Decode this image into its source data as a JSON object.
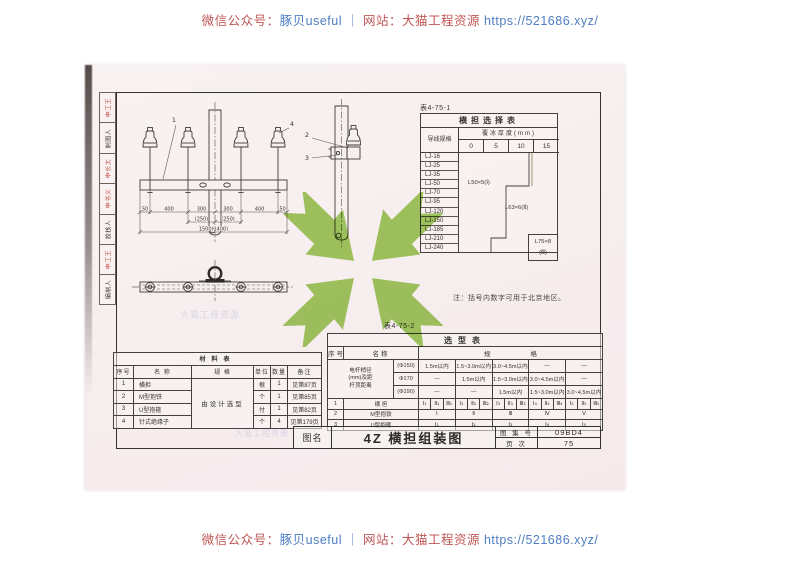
{
  "banner": {
    "wechat_label": "微信公众号：",
    "wechat_name": "豚贝useful",
    "separator": " ｜ ",
    "site_label": "网站：",
    "site_name": "大猫工程资源 ",
    "site_url": "https://521686.xyz/"
  },
  "stamps": [
    {
      "text": "申工王",
      "color": "red"
    },
    {
      "text": "制图人",
      "color": "black"
    },
    {
      "text": "申长太",
      "color": "red"
    },
    {
      "text": "申书义",
      "color": "red"
    },
    {
      "text": "校核人",
      "color": "black"
    },
    {
      "text": "申工王",
      "color": "red"
    },
    {
      "text": "编制人",
      "color": "black"
    }
  ],
  "drawing": {
    "front_label_1": "1",
    "front_label_4": "4",
    "side_label_2": "2",
    "side_label_3": "3",
    "dims_row1": [
      "50",
      "400",
      "300",
      "300",
      "400",
      "50"
    ],
    "dims_row2": [
      "(250)",
      "(250)"
    ],
    "dims_total": "1500(1400)"
  },
  "selection_table": {
    "caption": "表4-75-1",
    "title": "横担选择表",
    "corner_header": "导线规格",
    "ice_header": "覆冰厚度(mm)",
    "ice_values": [
      "0",
      "5",
      "10",
      "15"
    ],
    "conductors": [
      "LJ-16",
      "LJ-25",
      "LJ-35",
      "LJ-50",
      "LJ-70",
      "LJ-95",
      "LJ-120",
      "LJ-150",
      "LJ-185",
      "LJ-210",
      "LJ-240"
    ],
    "zone1": "L50×5(Ⅰ)",
    "zone2": "L63×6(Ⅱ)",
    "zone3_line1": "L75×8",
    "zone3_line2": "(Ⅲ)"
  },
  "note": "注：括号内数字可用于北京地区。",
  "type_table": {
    "caption": "表4-75-2",
    "title": "选型表",
    "col_seq": "序号",
    "col_name": "名称",
    "col_spec": "规格",
    "pole_label": "电杆梢径\n(mm)及距\n杆顶距离",
    "pole_rows": [
      {
        "dia": "(Φ150)",
        "specs": [
          "1.5m以内",
          "1.5~3.0m以内",
          "3.0~4.5m以内",
          "—",
          "—"
        ]
      },
      {
        "dia": "Φ170",
        "specs": [
          "—",
          "1.5m以内",
          "1.5~3.0m以内",
          "3.0~4.5m以内",
          "—"
        ]
      },
      {
        "dia": "(Φ190)",
        "specs": [
          "—",
          "—",
          "1.5m以内",
          "1.5~3.0m以内",
          "3.0~4.5m以内"
        ]
      }
    ],
    "item_rows": [
      {
        "no": "1",
        "name": "横 担",
        "cells": [
          "Ⅰ₁",
          "Ⅱ₁",
          "Ⅲ₁",
          "Ⅰ₂",
          "Ⅱ₂",
          "Ⅲ₂",
          "Ⅰ₃",
          "Ⅱ₃",
          "Ⅲ₃",
          "Ⅰ₄",
          "Ⅱ₄",
          "Ⅲ₄",
          "Ⅰ₅",
          "Ⅱ₅",
          "Ⅲ₅"
        ]
      },
      {
        "no": "2",
        "name": "M型抱铁",
        "cells": [
          "Ⅰ",
          "Ⅱ",
          "Ⅲ",
          "Ⅳ",
          "Ⅴ"
        ]
      },
      {
        "no": "3",
        "name": "U型抱箍",
        "cells": [
          "Ⅰ₁",
          "Ⅰ₂",
          "Ⅰ₃",
          "Ⅰ₄",
          "Ⅰ₅"
        ]
      }
    ]
  },
  "material_table": {
    "title": "材料表",
    "headers": [
      "序号",
      "名  称",
      "规  格",
      "单位",
      "数量",
      "备注"
    ],
    "spec_merged": "由设计选型",
    "rows": [
      {
        "no": "1",
        "name": "横担",
        "unit": "根",
        "qty": "1",
        "remark": "见第87页"
      },
      {
        "no": "2",
        "name": "M型抱铁",
        "unit": "个",
        "qty": "1",
        "remark": "见第85页"
      },
      {
        "no": "3",
        "name": "U型抱箍",
        "unit": "付",
        "qty": "1",
        "remark": "见第82页"
      },
      {
        "no": "4",
        "name": "针式绝缘子",
        "unit": "个",
        "qty": "4",
        "remark": "见第179页"
      }
    ]
  },
  "title_block": {
    "name_label": "图名",
    "drawing_name": "4Z 横担组装图",
    "atlas_label": "图 集 号",
    "atlas_no": "09BD4",
    "page_label": "页  次",
    "page_no": "75"
  },
  "watermark": {
    "ghost_text": "大猫工程资源",
    "x_color": "#9cca58"
  }
}
